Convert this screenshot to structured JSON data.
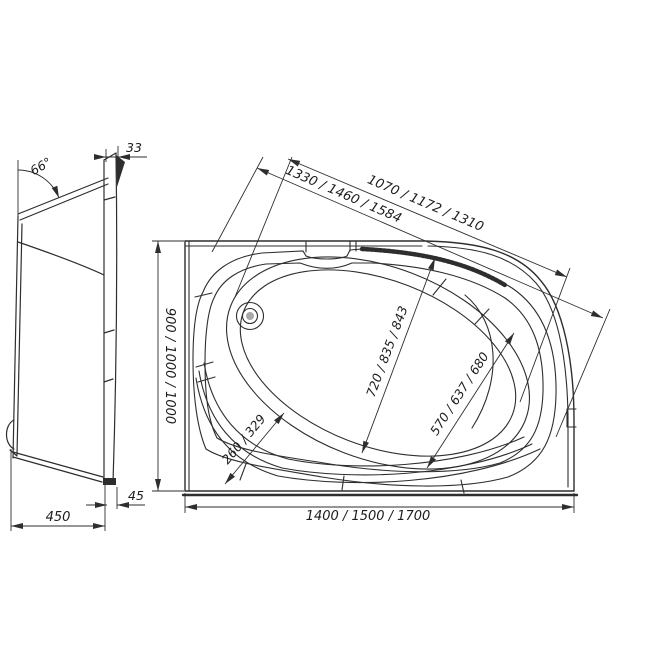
{
  "drawing": {
    "colors": {
      "line": "#2e2e2e",
      "background": "#ffffff"
    },
    "side_view": {
      "rim_angle": "66°",
      "rim_thickness": "33",
      "depth": "450",
      "base_offset": "45"
    },
    "plan_view": {
      "width_options": "900 / 1000 / 1000",
      "length_options": "1400 / 1500 / 1700",
      "outer_diagonal_options": "1330 / 1460 / 1584",
      "inner_diagonal_options": "1070 / 1172 / 1310",
      "bowl_length_options": "720 / 835 / 843",
      "bowl_width_options": "570 / 637 / 680",
      "apron_band_options": "260 / 329"
    }
  }
}
